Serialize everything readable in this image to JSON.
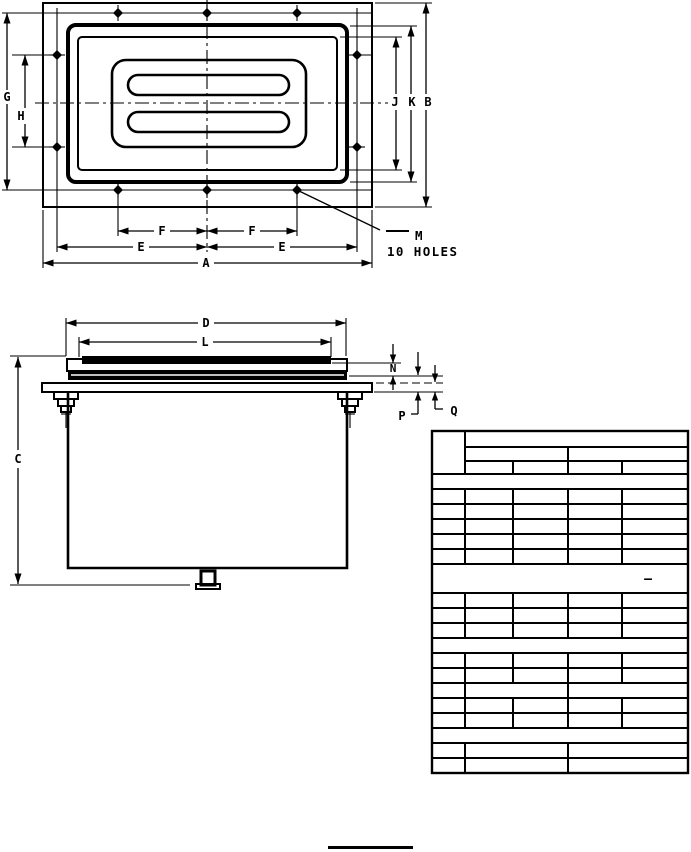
{
  "page": {
    "background": "#ffffff",
    "ink": "#000000"
  },
  "top_view": {
    "dim_a": "A",
    "dim_b": "B",
    "dim_e": "E",
    "dim_f": "F",
    "dim_g": "G",
    "dim_h": "H",
    "dim_j": "J",
    "dim_k": "K",
    "hole_callout": {
      "letter": "M",
      "note": "10 HOLES"
    }
  },
  "side_view": {
    "dim_c": "C",
    "dim_d": "D",
    "dim_l": "L",
    "dim_n": "N",
    "dim_p": "P",
    "dim_q": "Q"
  },
  "table": {
    "empty_cell_dash": "—"
  }
}
